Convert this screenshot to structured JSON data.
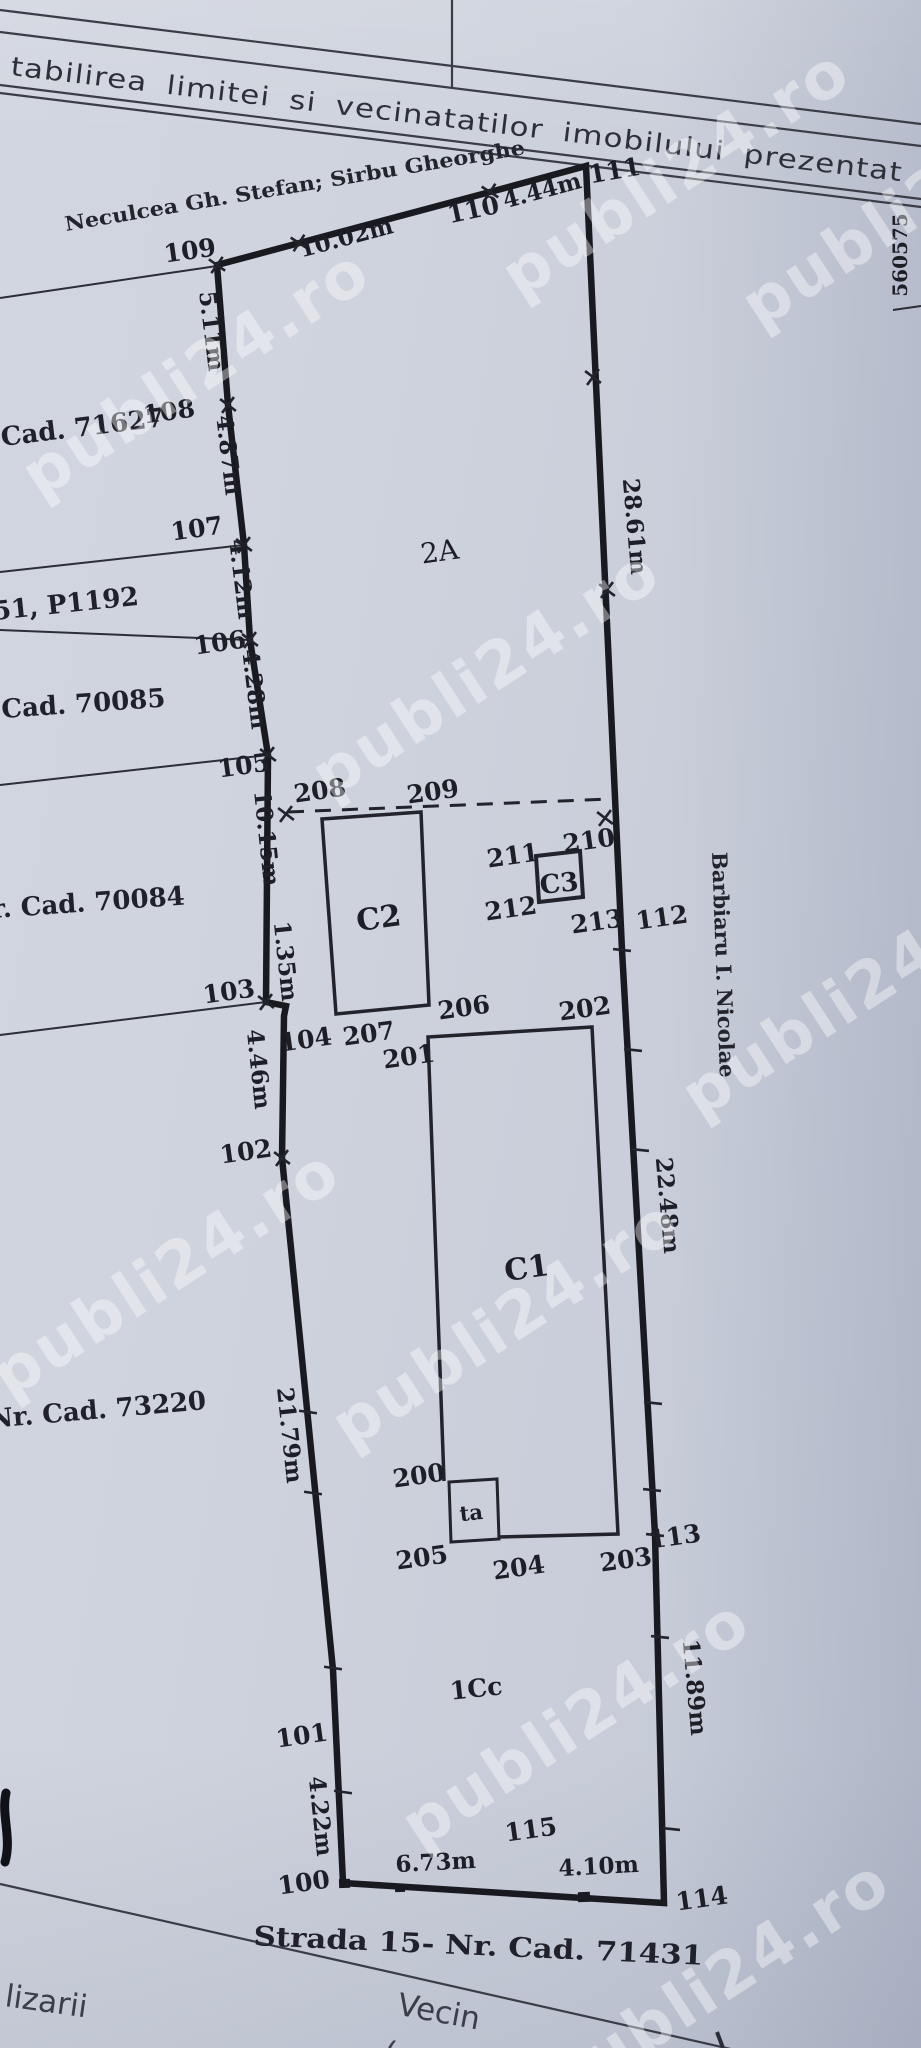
{
  "header": {
    "title": "tabilirea limitei si vecinatatilor imobilului prezentat",
    "grid_coordinate": "560575"
  },
  "watermark": "publi24.ro",
  "owners": {
    "top": "Neculcea Gh. Stefan; Sirbu Gheorghe",
    "right": "Barbiaru I. Nicolae"
  },
  "street": "Strada 15- Nr. Cad. 71431",
  "left_parcels": {
    "p71627": "Cad. 71627",
    "p1192": "51, P1192",
    "p70085": "Cad. 70085",
    "p70084": "r. Cad. 70084",
    "p73220": "Nr. Cad. 73220"
  },
  "zones": {
    "z2a": "2A",
    "z1cc": "1Cc"
  },
  "buildings": {
    "c1": "C1",
    "c2": "C2",
    "c3": "C3",
    "ta": "ta"
  },
  "points": {
    "p100": "100",
    "p101": "101",
    "p102": "102",
    "p103": "103",
    "p104": "104",
    "p105": "105",
    "p106": "106",
    "p107": "107",
    "p108": "108",
    "p109": "109",
    "p110": "110",
    "p111": "111",
    "p112": "112",
    "p113": "113",
    "p114": "114",
    "p115": "115",
    "p200": "200",
    "p201": "201",
    "p202": "202",
    "p203": "203",
    "p204": "204",
    "p205": "205",
    "p206": "206",
    "p207": "207",
    "p208": "208",
    "p209": "209",
    "p210": "210",
    "p211": "211",
    "p212": "212",
    "p213": "213"
  },
  "measures": {
    "m1002": "10.02m",
    "m444": "4.44m",
    "m511": "5.11m",
    "m487": "4.87m",
    "m412": "4.12m",
    "m428": "4.28m",
    "m1015": "10.15m",
    "m135": "1.35m",
    "m446": "4.46m",
    "m2179": "21.79m",
    "m422": "4.22m",
    "m2861": "28.61m",
    "m2248": "22.48m",
    "m1189": "11.89m",
    "m673": "6.73m",
    "m410": "4.10m"
  },
  "footer": {
    "left_fragment": "lizarii",
    "vecin": "Vecin",
    "nume_fragment": "(nume"
  }
}
